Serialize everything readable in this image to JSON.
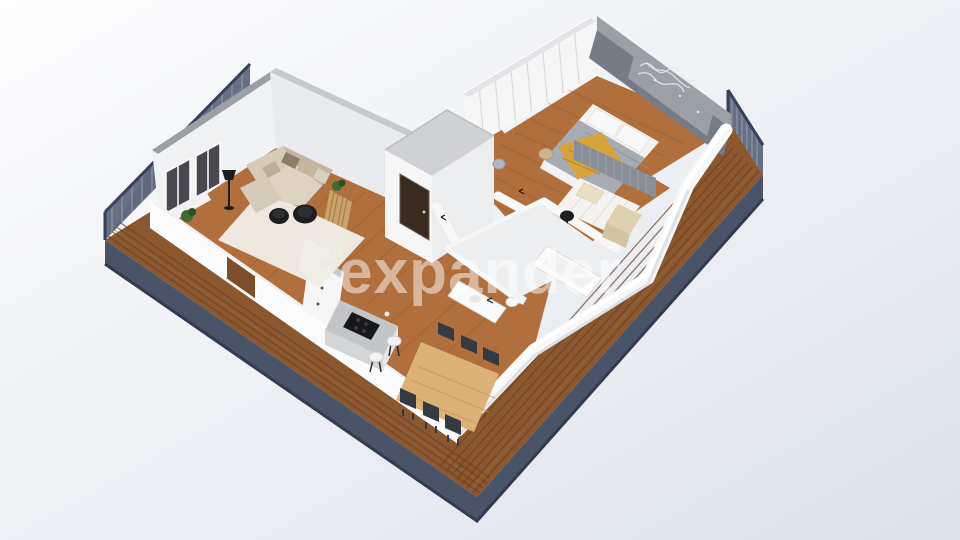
{
  "watermark": {
    "text": "expander"
  },
  "scene": {
    "type": "3d-isometric-floor-plan-render",
    "rooms": {
      "living_room": {
        "furniture": [
          "corner-sofa",
          "throw-pillows",
          "shag-rug",
          "round-black-coffee-tables",
          "floor-lamp",
          "windows",
          "potted-plant",
          "window-bench"
        ]
      },
      "kitchen": {
        "furniture": [
          "island-with-cooktop",
          "bar-stools",
          "white-cabinets",
          "oak-slat-partition",
          "sideboard"
        ]
      },
      "dining_area": {
        "furniture": [
          "wooden-dining-table",
          "six-dark-chairs"
        ]
      },
      "hallway": {
        "furniture": [
          "built-in-wardrobes",
          "entry-door",
          "round-stool"
        ]
      },
      "bedroom": {
        "furniture": [
          "double-bed",
          "white-pillows",
          "gray-duvet",
          "mustard-throw",
          "wardrobe-wall",
          "floral-mural-accent-wall",
          "bedside-stool"
        ]
      },
      "kids_room": {
        "furniture": [
          "single-bed",
          "cream-pillow",
          "beige-blanket",
          "black-side-table",
          "slat-panel-wall"
        ]
      },
      "bathroom": {
        "furniture": [
          "bathtub",
          "vanity-with-basin",
          "toilet"
        ]
      },
      "terrace": {
        "features": [
          "wood-decking",
          "navy-fascia",
          "slatted-railing-left",
          "slatted-railing-right"
        ]
      }
    }
  },
  "colors": {
    "bg_top": "#fdfdfe",
    "bg_bottom": "#dde2ea",
    "deck": "#8a572f",
    "deck_line": "#6b4023",
    "deck_light": "#9c6b3d",
    "fascia": "#4a5468",
    "fascia_dark": "#343b4e",
    "railing": "#4d5870",
    "railing_slat": "#9aa3b5",
    "wall_white": "#f8f8f9",
    "wall_face": "#fbfbfc",
    "wall_gray": "#e9ebee",
    "wall_cap": "#9aa0a6",
    "wall_cap_light": "#c6c9ce",
    "block_top": "#cfd1d4",
    "wood": "#b06f3c",
    "wood_streak": "#8d5526",
    "rug": "#f0ede7",
    "sofa": "#d6cab8",
    "sofa_dark": "#c3b5a1",
    "black": "#1d1d20",
    "door": "#3a2b20",
    "island": "#c3c6c8",
    "cooktop": "#17181a",
    "table_wood": "#ddb277",
    "chair": "#343a41",
    "duvet": "#a6abb4",
    "mattress": "#f4f3f0",
    "pillow": "#f8f8f8",
    "throw": "#d7a33c",
    "blanket": "#ded1b0",
    "accent_wall": "#767c85",
    "accent_panel": "#9ba0a7",
    "wardrobe": "#f6f6f7",
    "oak": "#c9a36b",
    "plant": "#3e6b33",
    "tile": "#edeff1",
    "fixture": "#fafafa",
    "watermark": "#ffffff"
  }
}
